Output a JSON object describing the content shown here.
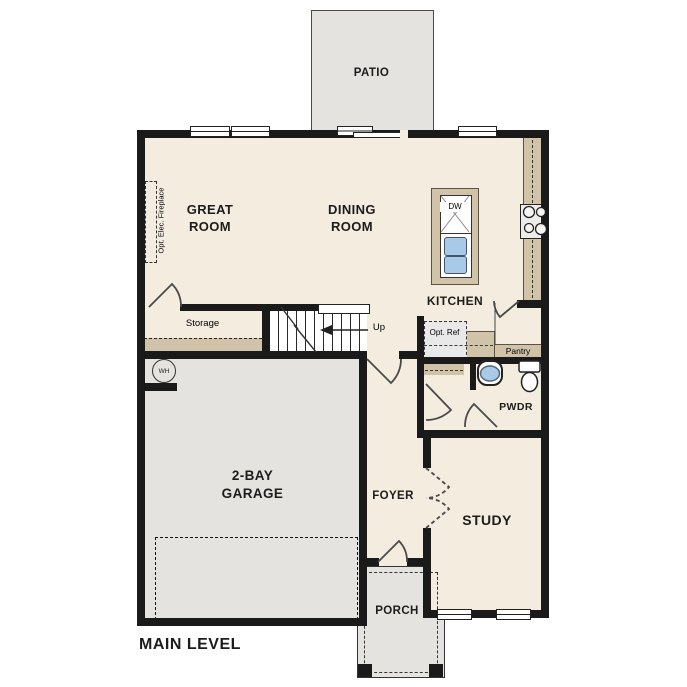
{
  "plan": {
    "title": "MAIN LEVEL",
    "labels": {
      "patio": "PATIO",
      "great_room": "GREAT ROOM",
      "dining_room": "DINING ROOM",
      "kitchen": "KITCHEN",
      "pantry": "Pantry",
      "storage": "Storage",
      "stairs_direction": "Up",
      "garage": "2-BAY GARAGE",
      "foyer": "FOYER",
      "powder_room": "PWDR",
      "study": "STUDY",
      "porch": "PORCH",
      "opt_fireplace": "Opt. Elec. Fireplace",
      "opt_refrigerator": "Opt. Ref",
      "water_heater": "WH",
      "dishwasher": "DW"
    },
    "colors": {
      "wall": "#1a1a1a",
      "floor": "#f3ecdf",
      "exterior": "#e4e3e0",
      "counter": "#d0c3a8",
      "fixture-blue": "#a9c9e8",
      "canvas": "#ffffff"
    }
  }
}
